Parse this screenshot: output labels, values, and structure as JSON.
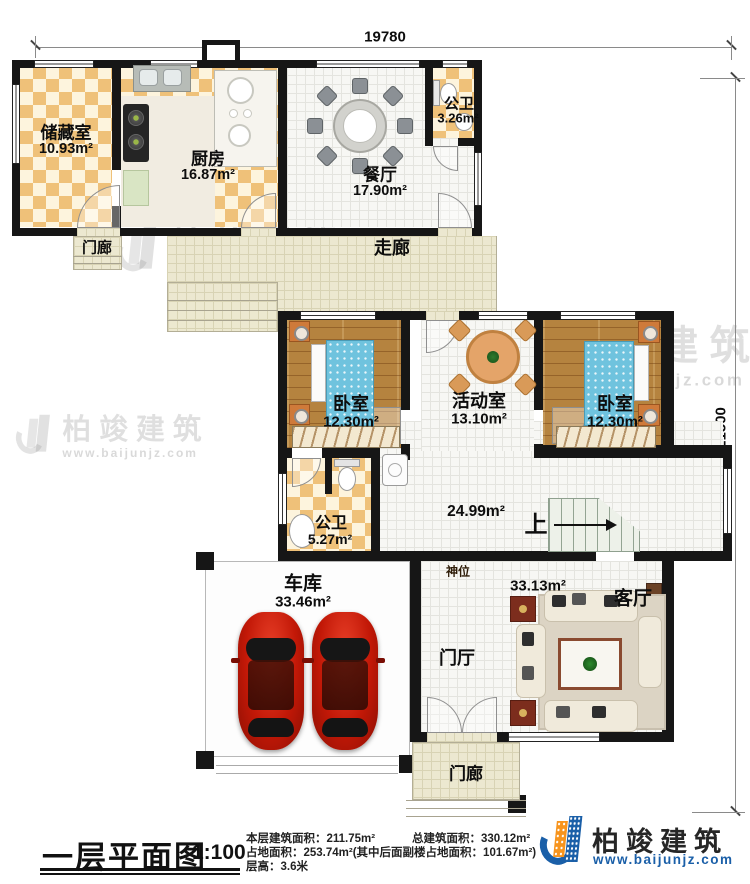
{
  "dimensions": {
    "top": "19780",
    "right": "21500"
  },
  "rooms": {
    "storage": {
      "name": "储藏室",
      "area": "10.93m²"
    },
    "kitchen": {
      "name": "厨房",
      "area": "16.87m²"
    },
    "dining": {
      "name": "餐厅",
      "area": "17.90m²"
    },
    "bath_top": {
      "name": "公卫",
      "area": "3.26m²"
    },
    "porch_top": {
      "name": "门廊"
    },
    "corridor": {
      "name": "走廊"
    },
    "bedroom_left": {
      "name": "卧室",
      "area": "12.30m²"
    },
    "activity": {
      "name": "活动室",
      "area": "13.10m²"
    },
    "bedroom_right": {
      "name": "卧室",
      "area": "12.30m²"
    },
    "bath_mid": {
      "name": "公卫",
      "area": "5.27m²"
    },
    "hall": {
      "area": "24.99m²"
    },
    "stairs": {
      "name": "上"
    },
    "garage": {
      "name": "车库",
      "area": "33.46m²"
    },
    "shrine": {
      "name": "神位"
    },
    "living": {
      "name": "客厅",
      "area": "33.13m²"
    },
    "foyer": {
      "name": "门厅"
    },
    "porch_bottom": {
      "name": "门廊"
    }
  },
  "footer": {
    "plan_title": "一层平面图",
    "scale": "1:100",
    "stat1a": "本层建筑面积：211.75m²",
    "stat1b": "总建筑面积：330.12m²",
    "stat2": "占地面积：253.74m²(其中后面副楼占地面积：101.67m²)",
    "stat3": "层高：3.6米"
  },
  "brand": {
    "name": "柏竣建筑",
    "site": "www.baijunjz.com"
  },
  "watermark": {
    "name": "柏竣建筑",
    "site": "www.baijunjz.com"
  },
  "colors": {
    "wall": "#161616",
    "checker_tile": "#efc179",
    "wood": "#b5833f",
    "bed_blue": "#6fc3de",
    "car_red": "#c21807",
    "brand_blue": "#1a5fa8",
    "brand_orange": "#f7941d"
  }
}
